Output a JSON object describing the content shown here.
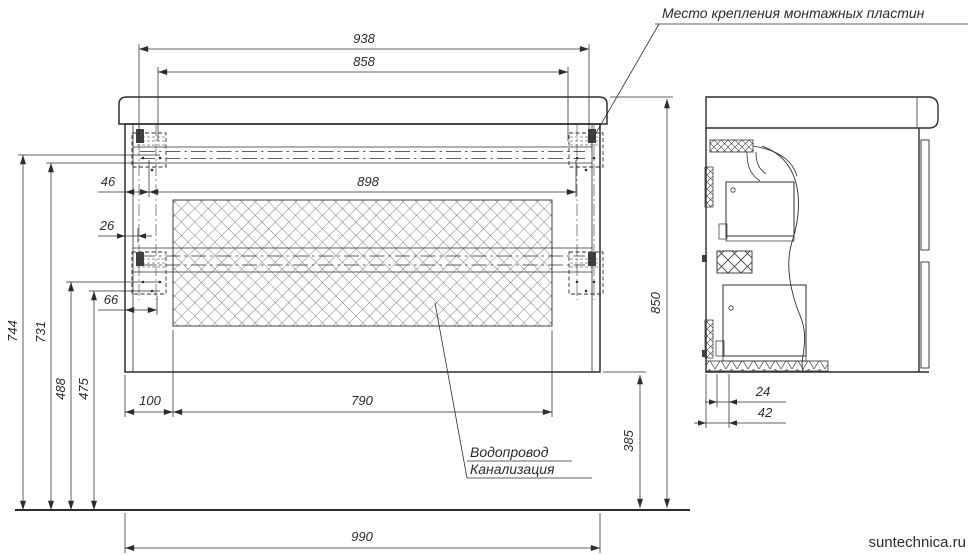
{
  "drawing": {
    "type": "technical-drawing",
    "subject": "wall-hung vanity cabinet, front and side views with mounting dimensions"
  },
  "annotations": {
    "mounting_plates": "Место крепления монтажных пластин",
    "water_supply": "Водопровод",
    "sewerage": "Канализация"
  },
  "watermark": {
    "text": "suntechnica.ru"
  },
  "dims": {
    "w990": "990",
    "w938": "938",
    "w858": "858",
    "w898": "898",
    "w790": "790",
    "o46": "46",
    "o26": "26",
    "o66": "66",
    "o100": "100",
    "h850": "850",
    "h744": "744",
    "h731": "731",
    "h488": "488",
    "h475": "475",
    "h385": "385",
    "d24": "24",
    "d42": "42"
  },
  "dimension_list": [
    {
      "name": "overall width",
      "value": 990,
      "unit": "mm"
    },
    {
      "name": "mounting plate outer holes span",
      "value": 938,
      "unit": "mm"
    },
    {
      "name": "mounting plate inner holes span",
      "value": 858,
      "unit": "mm"
    },
    {
      "name": "inner opening width",
      "value": 898,
      "unit": "mm"
    },
    {
      "name": "service opening width",
      "value": 790,
      "unit": "mm"
    },
    {
      "name": "edge to opening offset",
      "value": 46,
      "unit": "mm"
    },
    {
      "name": "edge offset",
      "value": 26,
      "unit": "mm"
    },
    {
      "name": "edge offset lower plate",
      "value": 66,
      "unit": "mm"
    },
    {
      "name": "service opening side offset",
      "value": 100,
      "unit": "mm"
    },
    {
      "name": "overall height from floor",
      "value": 850,
      "unit": "mm"
    },
    {
      "name": "floor to upper holes row 1",
      "value": 744,
      "unit": "mm"
    },
    {
      "name": "floor to upper holes row 2",
      "value": 731,
      "unit": "mm"
    },
    {
      "name": "floor to lower holes row 1",
      "value": 488,
      "unit": "mm"
    },
    {
      "name": "floor to lower holes row 2",
      "value": 475,
      "unit": "mm"
    },
    {
      "name": "floor to cabinet bottom",
      "value": 385,
      "unit": "mm"
    },
    {
      "name": "side depth 24",
      "value": 24,
      "unit": "mm"
    },
    {
      "name": "side depth 42",
      "value": 42,
      "unit": "mm"
    }
  ],
  "colors": {
    "line": "#2d2d2d",
    "hatch": "#4a4a4a",
    "watermark": "#a9a9a9",
    "background": "#ffffff"
  }
}
